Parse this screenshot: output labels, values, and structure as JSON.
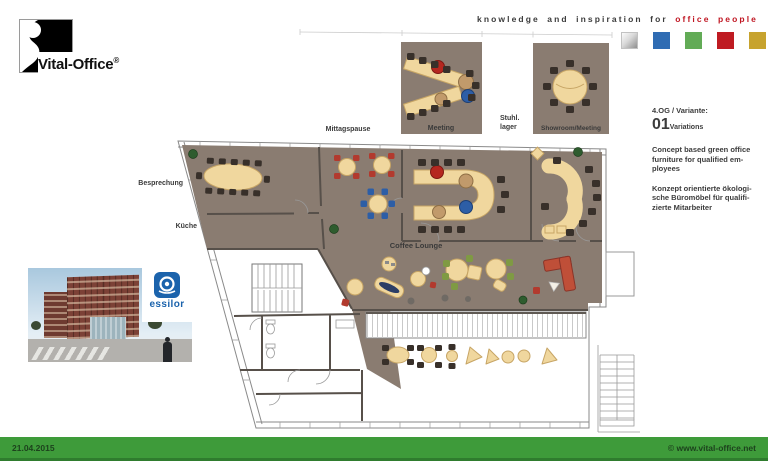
{
  "header": {
    "logo_text": "Vital-Office",
    "logo_reg": "®",
    "tagline_black": "knowledge and inspiration for",
    "tagline_red": "office people",
    "palette_colors": {
      "silver": "#c9c9c9",
      "blue": "#2f6cb3",
      "green": "#62ab56",
      "red": "#bf1b22",
      "gold": "#c7a32e"
    }
  },
  "plan": {
    "labels": {
      "besprechung": "Besprechung",
      "kueche": "Küche",
      "mittagspause": "Mittagspause",
      "meeting": "Meeting",
      "stuhllager_line1": "Stuhl.",
      "stuhllager_line2": "lager",
      "showroom": "Showroom/Meeting",
      "coffee_lounge": "Coffee Lounge"
    },
    "colors": {
      "floor": "#8a7c71",
      "table_cream": "#f0d79e",
      "chair_dark": "#38302a",
      "chair_red": "#b23a2e",
      "chair_blue": "#2d5ea6",
      "chair_green": "#7f9a43",
      "sofa_red": "#bf4f38",
      "plant_green": "#2e5c2e"
    }
  },
  "info_panel": {
    "floor_variant": "4.OG / Variante:",
    "variant_number": "01",
    "variant_word": "Variations",
    "concept_en": "Concept based green office\nfurniture for qualified em-\nployees",
    "concept_de": "Konzept orientierte ökologi-\nsche Büromöbel für qualifi-\nzierte Mitarbeiter"
  },
  "photo": {
    "brand": "essilor"
  },
  "footer": {
    "date": "21.04.2015",
    "copyright": "© www.vital-office.net",
    "bar_color": "#3e9b3a"
  }
}
